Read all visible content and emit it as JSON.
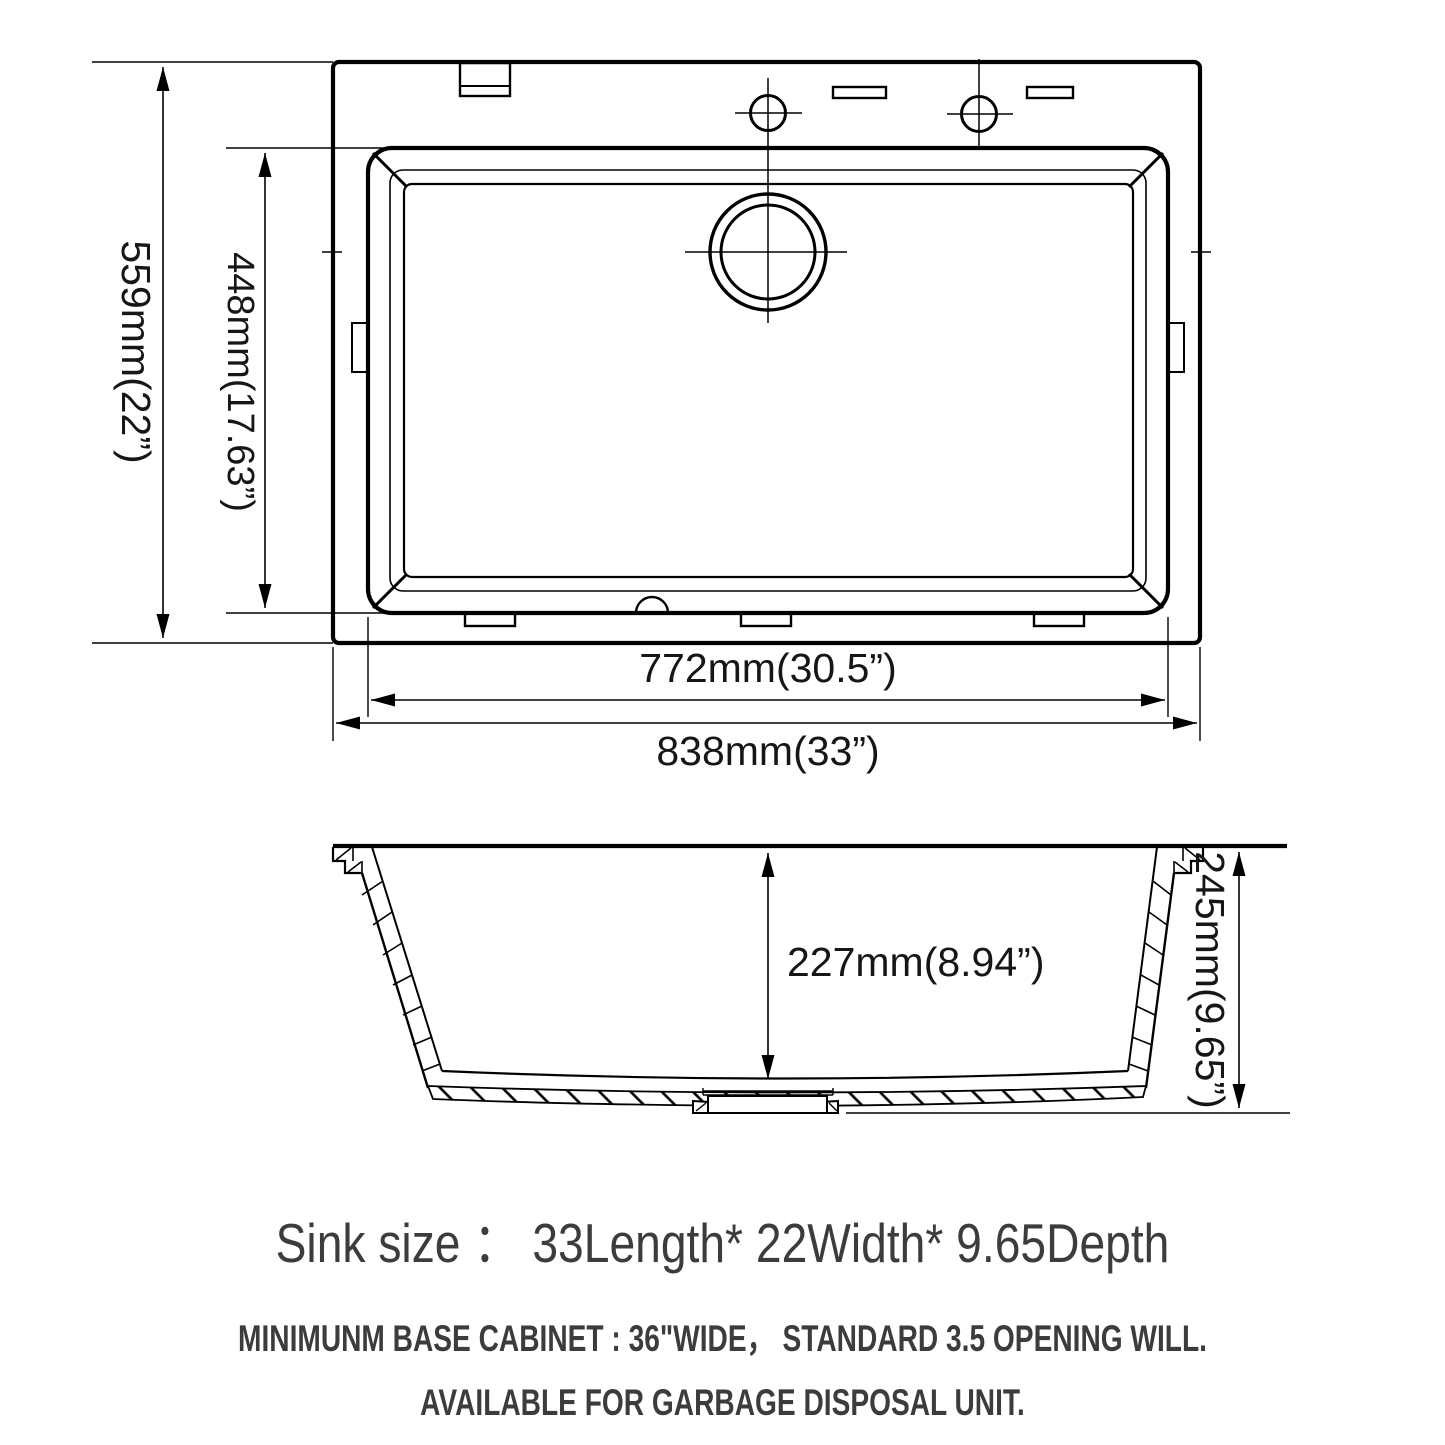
{
  "dimensions": {
    "top_view": {
      "height_outer": "559mm(22”)",
      "height_inner": "448mm(17.63”)",
      "width_inner": "772mm(30.5”)",
      "width_outer": "838mm(33”)"
    },
    "section_view": {
      "depth_inner": "227mm(8.94”)",
      "depth_outer": "245mm(9.65”)"
    }
  },
  "notes": {
    "size_line": "Sink size ： 33Length* 22Width* 9.65Depth",
    "cabinet_line": "MINIMUNM BASE CABINET : 36\"WIDE，  STANDARD 3.5 OPENING WILL.",
    "disposal_line": "AVAILABLE FOR GARBAGE DISPOSAL UNIT."
  },
  "colors": {
    "line": "#000000",
    "note_text": "#3c3c3c"
  }
}
